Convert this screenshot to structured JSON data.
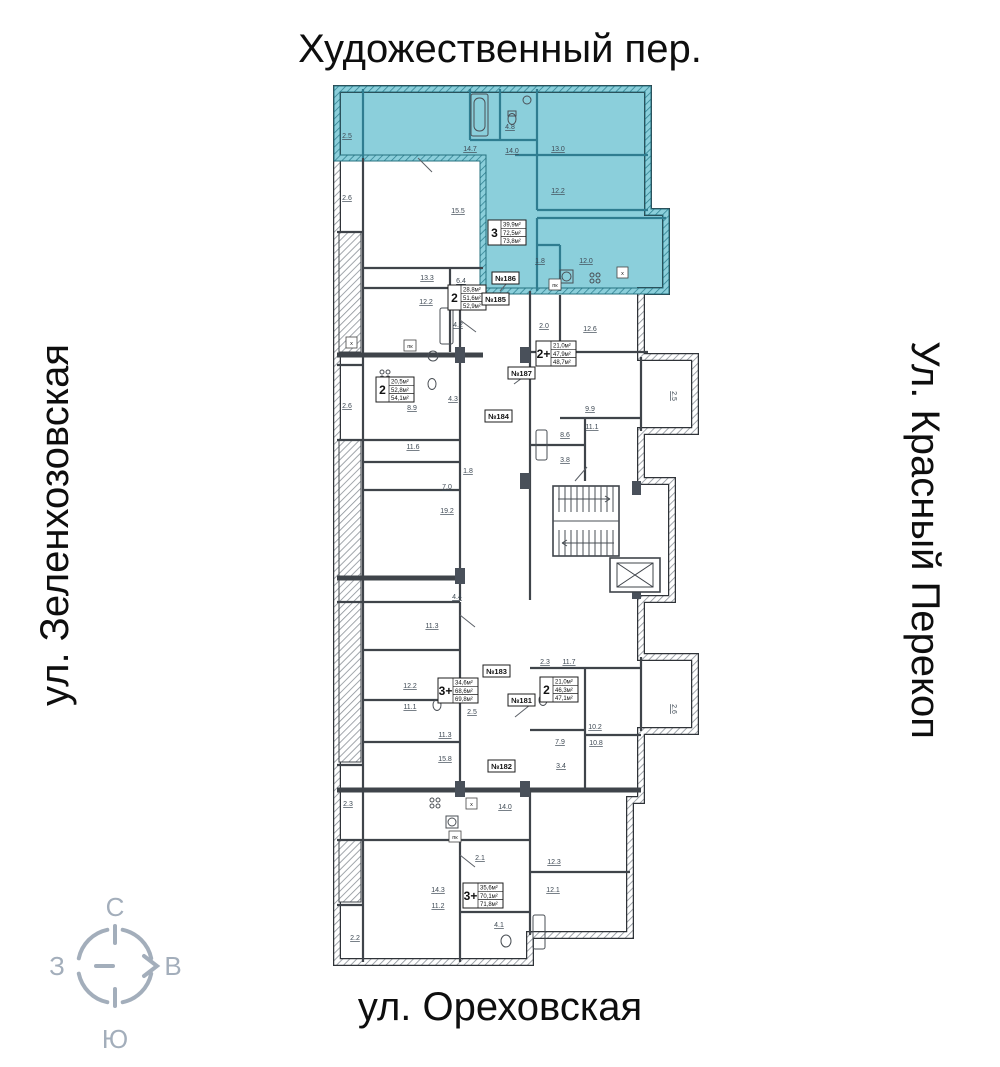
{
  "streets": {
    "top": "Художественный пер.",
    "left": "ул. Зеленхозовская",
    "right": "Ул. Красный Перекоп",
    "bottom": "ул. Ореховская"
  },
  "compass": {
    "north": "С",
    "south": "Ю",
    "west": "З",
    "east": "В"
  },
  "colors": {
    "highlight": "#8bcfdb",
    "highlight_wall": "#2f7d90",
    "wall": "#3f444a",
    "dim_text": "#3f4a55",
    "compass": "#a3aebb",
    "text": "#0e0e0e"
  },
  "apartments": [
    {
      "number": "№186",
      "rooms": "3",
      "area_living": "39,9м²",
      "area_main": "72,5м²",
      "area_total": "73,8м²",
      "highlighted": true
    },
    {
      "number": "№185",
      "rooms": "2",
      "area_living": "28,8м²",
      "area_main": "51,6м²",
      "area_total": "52,9м²",
      "highlighted": false
    },
    {
      "number": "№187",
      "rooms": "2+",
      "area_living": "21,0м²",
      "area_main": "47,9м²",
      "area_total": "48,7м²",
      "highlighted": false
    },
    {
      "number": "№184",
      "rooms": "2",
      "area_living": "20,5м²",
      "area_main": "52,8м²",
      "area_total": "54,1м²",
      "highlighted": false
    },
    {
      "number": "№183",
      "rooms": "3+",
      "area_living": "34,6м²",
      "area_main": "68,6м²",
      "area_total": "69,8м²",
      "highlighted": false
    },
    {
      "number": "№181",
      "rooms": "2",
      "area_living": "21,0м²",
      "area_main": "46,3м²",
      "area_total": "47,1м²",
      "highlighted": false
    },
    {
      "number": "№182",
      "rooms": "3+",
      "area_living": "35,6м²",
      "area_main": "70,1м²",
      "area_total": "71,8м²",
      "highlighted": false
    }
  ],
  "dims": [
    "2.5",
    "2.6",
    "14.7",
    "14.0",
    "4.8",
    "13.0",
    "12.2",
    "15.5",
    "1.8",
    "12.0",
    "13.3",
    "6.4",
    "12.2",
    "4.2",
    "2.0",
    "12.6",
    "2.6",
    "8.9",
    "4.3",
    "9.9",
    "11.1",
    "8.6",
    "3.8",
    "11.6",
    "1.8",
    "7.0",
    "19.2",
    "4.4",
    "11.3",
    "12.2",
    "11.1",
    "2.5",
    "11.3",
    "15.8",
    "2.3",
    "11.7",
    "10.2",
    "10.8",
    "7.9",
    "3.4",
    "2.3",
    "14.0",
    "2.1",
    "14.3",
    "11.2",
    "12.3",
    "12.1",
    "4.1",
    "2.2",
    "2.5",
    "2.6"
  ],
  "micro_labels": [
    "x",
    "пк",
    "x",
    "пк",
    "x",
    "пк"
  ]
}
